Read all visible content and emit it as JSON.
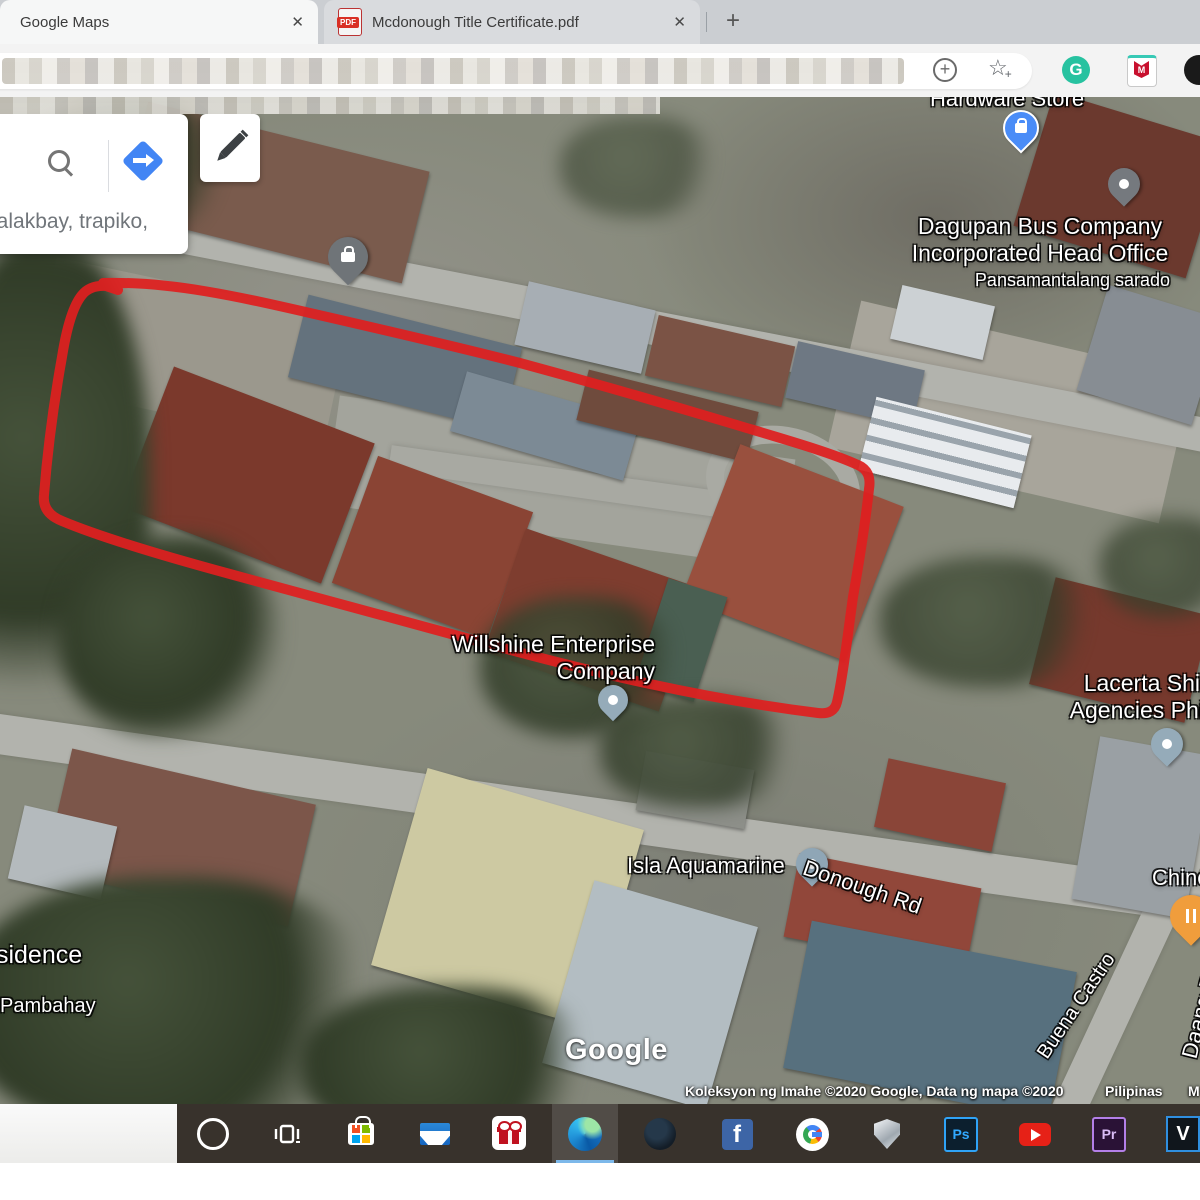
{
  "browser": {
    "tabs": [
      {
        "title": "Google Maps",
        "close": "✕"
      },
      {
        "title": "Mcdonough Title Certificate.pdf",
        "close": "✕",
        "favicon_label": "PDF"
      }
    ],
    "new_tab": "+",
    "toolbar": {
      "collections_plus": "+",
      "grammarly_letter": "G",
      "mcafee_letter": "M",
      "favorite_star": "☆",
      "favorite_plus": "+"
    }
  },
  "maps_ui": {
    "search_text": "lalakbay, trapiko,"
  },
  "labels": {
    "hardware": "Hardware Store",
    "dagupan": "Dagupan Bus Company\nIncorporated Head Office",
    "dagupan_status": "Pansamantalang sarado",
    "willshine": "Willshine Enterprise\nCompany",
    "lacerta": "Lacerta Shipping\nAgencies Phils., Inc",
    "isla": "Isla Aquamarine",
    "donough": "Donough Rd",
    "residence": "Residence",
    "pambahay": "Pambahay",
    "buena": "Buena Castro",
    "daang": "Daang Rad",
    "chinese": "Chines",
    "watermark": "Google",
    "attribution": "Koleksyon ng Imahe ©2020 Google, Data ng mapa ©2020",
    "region": "Pilipinas",
    "more": "M"
  },
  "taskbar": {
    "ps": "Ps",
    "pr": "Pr",
    "v": "V",
    "fb": "f"
  },
  "colors": {
    "outline_red": "#df1f1f",
    "pin_blue": "#4a8cf7",
    "pin_gray": "#75797e",
    "pin_place": "#95abb9",
    "pin_orange": "#f09d3c",
    "taskbar_bg": "#38322c",
    "edge_underline": "#7cb8ea",
    "directions_blue": "#4285f4"
  }
}
